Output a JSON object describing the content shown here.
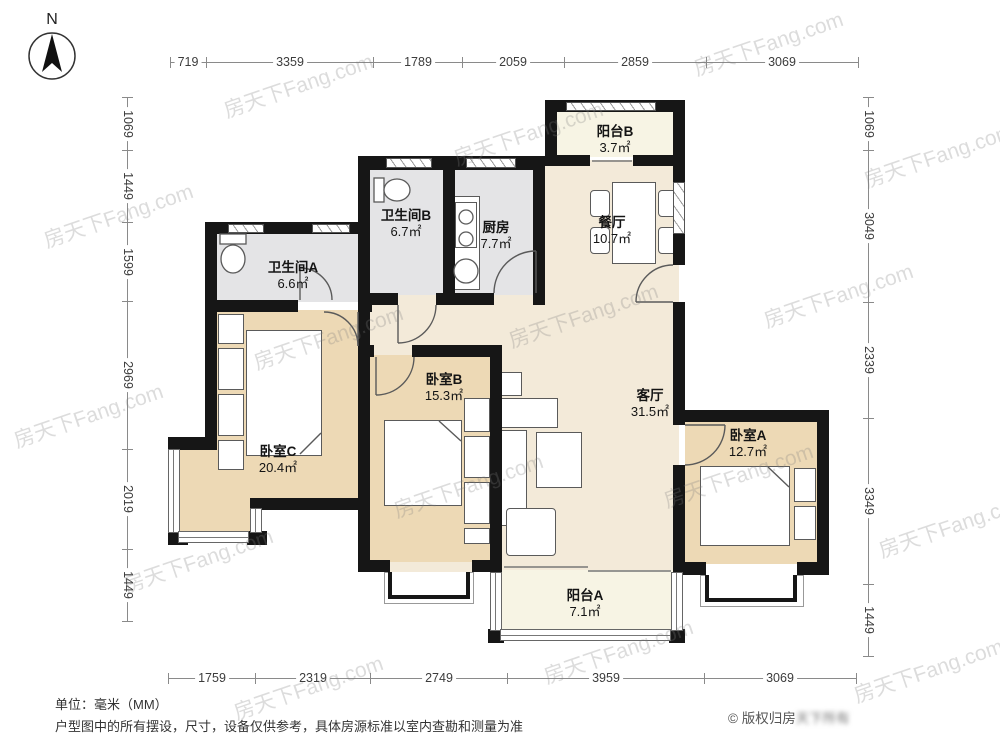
{
  "meta": {
    "watermark": "房天下Fang.com",
    "compass_letter": "N",
    "copyright_visible": "© 版权归房",
    "copyright_blurred": "天下所有"
  },
  "footer": {
    "unit": "单位：毫米（MM）",
    "disclaimer": "户型图中的所有摆设，尺寸，设备仅供参考，具体房源标准以室内查勘和测量为准"
  },
  "rooms": [
    {
      "name": "阳台B",
      "area": "3.7㎡"
    },
    {
      "name": "卫生间B",
      "area": "6.7㎡"
    },
    {
      "name": "厨房",
      "area": "7.7㎡"
    },
    {
      "name": "餐厅",
      "area": "10.7㎡"
    },
    {
      "name": "卫生间A",
      "area": "6.6㎡"
    },
    {
      "name": "卧室B",
      "area": "15.3㎡"
    },
    {
      "name": "客厅",
      "area": "31.5㎡"
    },
    {
      "name": "卧室C",
      "area": "20.4㎡"
    },
    {
      "name": "卧室A",
      "area": "12.7㎡"
    },
    {
      "name": "阳台A",
      "area": "7.1㎡"
    }
  ],
  "dims": {
    "unit_mm": true,
    "top": [
      "719",
      "3359",
      "1789",
      "2059",
      "2859",
      "3069"
    ],
    "left": [
      "1069",
      "1449",
      "1599",
      "2969",
      "2019",
      "1449"
    ],
    "right": [
      "1069",
      "3049",
      "2339",
      "3349",
      "1449"
    ],
    "bottom": [
      "1759",
      "2319",
      "2749",
      "3959",
      "3069"
    ]
  },
  "colors": {
    "wall": "#161616",
    "bedroom_fill": "#edd9b5",
    "living_fill": "#f3ead9",
    "bath_kitchen_fill": "#e4e4e6",
    "balcony_fill": "#f7f4e4"
  }
}
